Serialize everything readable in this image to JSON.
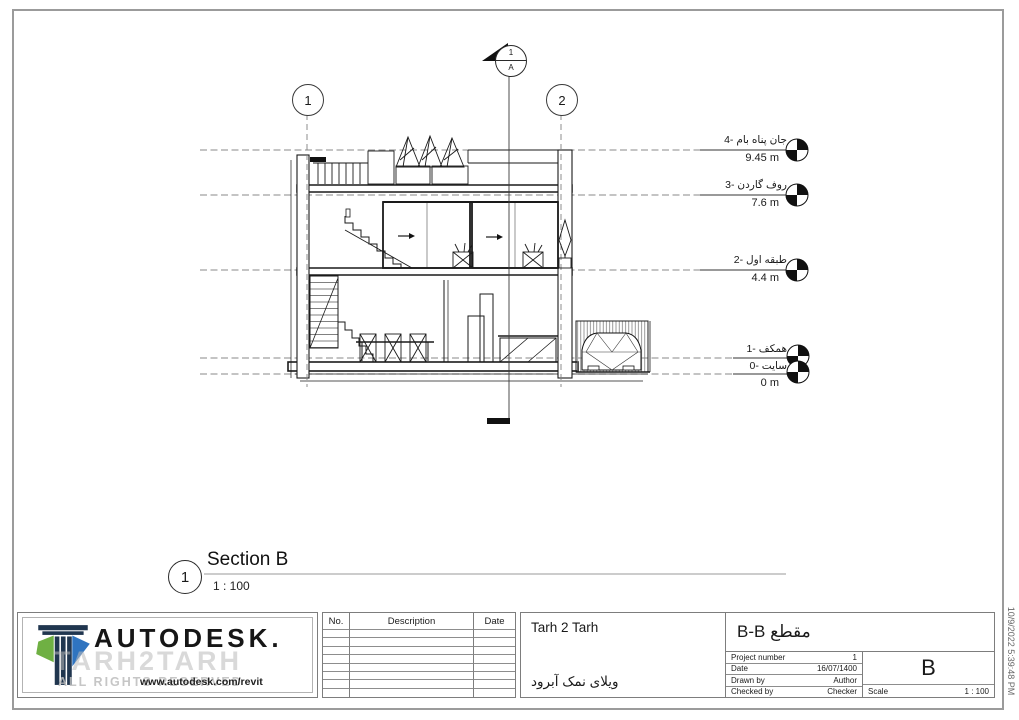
{
  "drawing": {
    "grids": [
      {
        "label": "1"
      },
      {
        "label": "2"
      }
    ],
    "section_head": {
      "top": "1",
      "bottom": "A"
    },
    "levels": [
      {
        "name": "جان پناه بام -4",
        "elevation": "9.45 m"
      },
      {
        "name": "روف گاردن -3",
        "elevation": "7.6 m"
      },
      {
        "name": "طبقه اول -2",
        "elevation": "4.4 m"
      },
      {
        "name": "همکف -1",
        "elevation": ""
      },
      {
        "name": "سایت -0",
        "elevation": "0 m"
      }
    ],
    "view_title": {
      "number": "1",
      "title": "Section B",
      "scale": "1 : 100"
    }
  },
  "title_block": {
    "logo": {
      "brand": "AUTODESK.",
      "watermark": "TARH2TARH",
      "watermark2": "ALL RIGHTS RESERVED",
      "url": "www.autodesk.com/revit"
    },
    "revisions": {
      "headers": [
        "No.",
        "Description",
        "Date"
      ]
    },
    "project": {
      "client": "Tarh 2 Tarh",
      "name": "ویلای نمک آبرود"
    },
    "sheet": {
      "title": "مقطع B-B",
      "number": "B",
      "fields": [
        {
          "label": "Project number",
          "value": "1"
        },
        {
          "label": "Date",
          "value": "16/07/1400"
        },
        {
          "label": "Drawn by",
          "value": "Author"
        },
        {
          "label": "Checked by",
          "value": "Checker"
        }
      ],
      "scale_label": "Scale",
      "scale": "1 : 100"
    }
  },
  "timestamp": "10/9/2022 5:39:48 PM",
  "colors": {
    "line": "#1a1a1a",
    "sheet_border": "#9b9b9b",
    "logo_green": "#6fb043",
    "logo_blue": "#2f74c0"
  }
}
